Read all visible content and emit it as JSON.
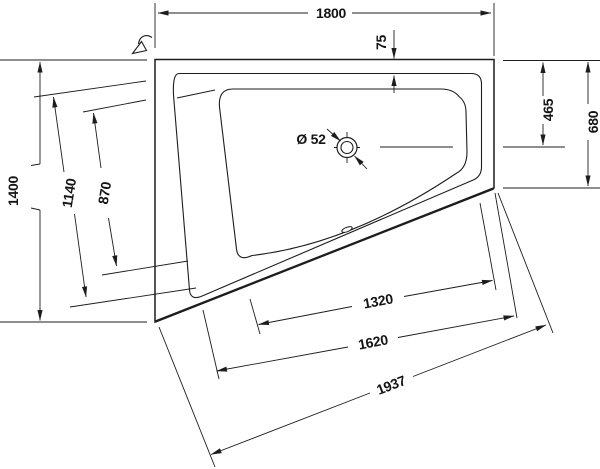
{
  "drawing": {
    "type": "technical-drawing",
    "subject": "corner bathtub plan view with dimensions",
    "colors": {
      "line": "#1d1d1d",
      "background": "#ffffff",
      "text": "#141414"
    },
    "dimensions": {
      "top_width": "1800",
      "rim_top_offset": "75",
      "drain_from_top": "465",
      "right_side_total": "680",
      "left_side_total": "1400",
      "backrest_rim_length": "1140",
      "backrest_basin_length": "870",
      "drain_diameter": "Ø 52",
      "basin_bottom_length": "1320",
      "rim_bottom_length": "1620",
      "outer_bottom_length": "1937"
    },
    "icons": [
      {
        "name": "view-direction-arrow-icon"
      },
      {
        "name": "drain-symbol"
      },
      {
        "name": "overflow-marker"
      }
    ]
  }
}
